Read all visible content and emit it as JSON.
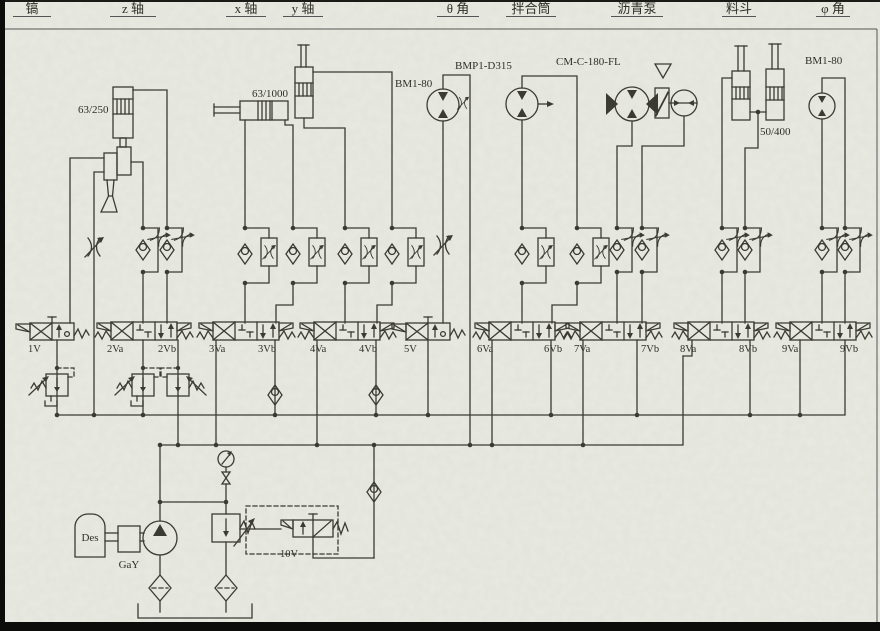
{
  "columns": [
    {
      "label": "镐"
    },
    {
      "label": "z 轴"
    },
    {
      "label": "x 轴"
    },
    {
      "label": "y 轴"
    },
    {
      "label": "θ 角"
    },
    {
      "label": "拌合筒"
    },
    {
      "label": "沥青泵"
    },
    {
      "label": "料斗"
    },
    {
      "label": "φ 角"
    }
  ],
  "components": {
    "z_cylinder": "63/250",
    "x_cylinder": "63/1000",
    "theta_motor": "BM1-80",
    "mixer_motor": "BMP1-D315",
    "asphalt_pump": "CM-C-180-FL",
    "hopper_cylinders": "50/400",
    "phi_motor": "BM1-80"
  },
  "valves": {
    "v1": "1V",
    "v2a": "2Va",
    "v2b": "2Vb",
    "v3a": "3Va",
    "v3b": "3Vb",
    "v4a": "4Va",
    "v4b": "4Vb",
    "v5": "5V",
    "v6a": "6Va",
    "v6b": "6Vb",
    "v7a": "7Va",
    "v7b": "7Vb",
    "v8a": "8Va",
    "v8b": "8Vb",
    "v9a": "9Va",
    "v9b": "9Vb",
    "v10": "10V"
  },
  "power_unit": {
    "motor_label": "Des",
    "coupling_label": "GaY"
  },
  "colors": {
    "ink": "#3b3b32",
    "paper": "#e9eae1"
  }
}
